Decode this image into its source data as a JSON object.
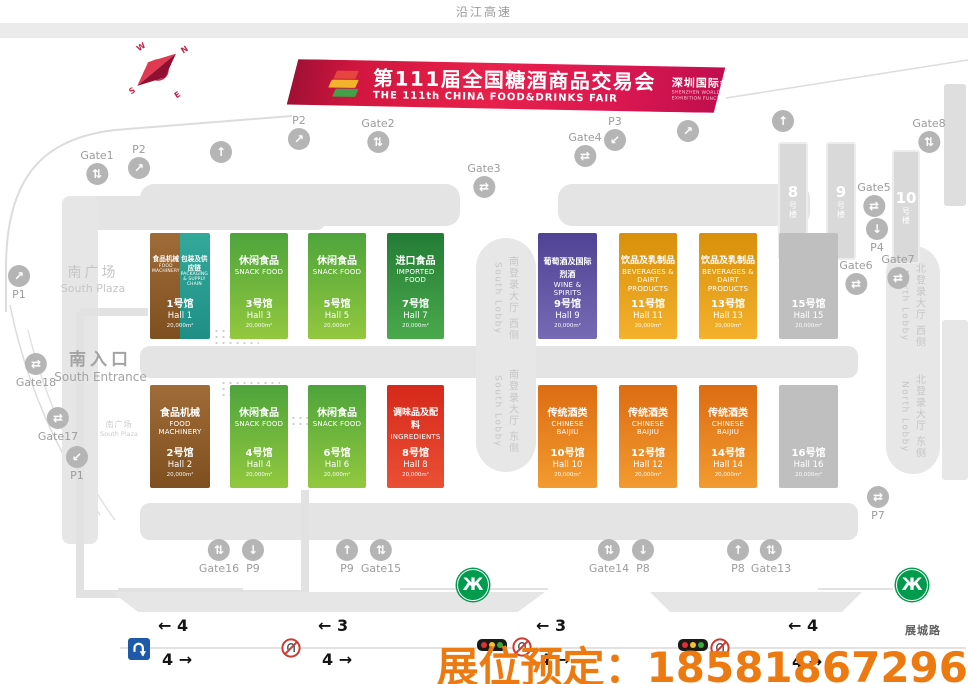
{
  "page": {
    "top_road": "沿江高速",
    "bottom_road": "展城路",
    "booking": "展位预定：18581867296"
  },
  "colors": {
    "banner_red": "#DD1C47",
    "booking_orange": "#EC7A10",
    "hall_brown": "#96622E",
    "hall_teal": "#2BA395",
    "hall_green": "#5FAE3C",
    "hall_dark_green": "#2E8F3C",
    "hall_purple": "#5D4F9E",
    "hall_amber": "#E9960E",
    "hall_orange": "#E9780F",
    "hall_red": "#DD2F1D",
    "hall_gray": "#BFBFBF",
    "metro_green": "#009B4C"
  },
  "banner": {
    "title_cn": "第111届全国糖酒商品交易会",
    "title_en": "THE 111th CHINA FOOD&DRINKS FAIR",
    "subtitle_cn": "深圳国际会展中心展区功能图",
    "subtitle_en1": "SHENZHEN WORLD EXHIBITION & CONVENTION CENTER",
    "subtitle_en2": "EXHIBITION FUNCTION DIAGRAM"
  },
  "compass": {
    "w": "W",
    "n": "N",
    "e": "E",
    "s": "S"
  },
  "areas": {
    "plaza_cn": "南广场",
    "plaza_en": "South Plaza",
    "entrance_cn": "南入口",
    "entrance_en": "South Entrance",
    "plaza_small_cn": "南广场",
    "plaza_small_en": "South Plaza"
  },
  "lobbies": {
    "south_west_cn": "南登录大厅 西侧",
    "south_west_en": "South Lobby",
    "south_east_cn": "南登录大厅 东侧",
    "south_east_en": "South Lobby",
    "north_west_cn": "北登录大厅 西侧",
    "north_west_en": "North Lobby",
    "north_east_cn": "北登录大厅 东侧",
    "north_east_en": "North Lobby"
  },
  "buildings": [
    {
      "no": "8",
      "suffix": "号楼"
    },
    {
      "no": "9",
      "suffix": "号楼"
    },
    {
      "no": "10",
      "suffix": "号楼"
    }
  ],
  "halls": [
    {
      "no": "1",
      "cat_cn": "食品机械",
      "cat_en": "FOOD MACHINERY",
      "cat2_cn": "包装及供应链",
      "cat2_en": "PACKAGING & SUPPLY CHAIN",
      "hall_cn": "1号馆",
      "hall_en": "Hall 1",
      "area": "20,000m²"
    },
    {
      "no": "2",
      "cat_cn": "食品机械",
      "cat_en": "FOOD MACHINERY",
      "hall_cn": "2号馆",
      "hall_en": "Hall 2",
      "area": "20,000m²"
    },
    {
      "no": "3",
      "cat_cn": "休闲食品",
      "cat_en": "SNACK FOOD",
      "hall_cn": "3号馆",
      "hall_en": "Hall 3",
      "area": "20,000m²"
    },
    {
      "no": "4",
      "cat_cn": "休闲食品",
      "cat_en": "SNACK FOOD",
      "hall_cn": "4号馆",
      "hall_en": "Hall 4",
      "area": "20,000m²"
    },
    {
      "no": "5",
      "cat_cn": "休闲食品",
      "cat_en": "SNACK FOOD",
      "hall_cn": "5号馆",
      "hall_en": "Hall 5",
      "area": "20,000m²"
    },
    {
      "no": "6",
      "cat_cn": "休闲食品",
      "cat_en": "SNACK FOOD",
      "hall_cn": "6号馆",
      "hall_en": "Hall 6",
      "area": "20,000m²"
    },
    {
      "no": "7",
      "cat_cn": "进口食品",
      "cat_en": "IMPORTED FOOD",
      "hall_cn": "7号馆",
      "hall_en": "Hall 7",
      "area": "20,000m²"
    },
    {
      "no": "8",
      "cat_cn": "调味品及配料",
      "cat_en": "INGREDIENTS",
      "hall_cn": "8号馆",
      "hall_en": "Hall 8",
      "area": "20,000m²"
    },
    {
      "no": "9",
      "cat_cn": "葡萄酒及国际烈酒",
      "cat_en": "WINE & SPIRITS",
      "hall_cn": "9号馆",
      "hall_en": "Hall 9",
      "area": "20,000m²"
    },
    {
      "no": "10",
      "cat_cn": "传统酒类",
      "cat_en": "CHINESE BAIJIU",
      "hall_cn": "10号馆",
      "hall_en": "Hall 10",
      "area": "20,000m²"
    },
    {
      "no": "11",
      "cat_cn": "饮品及乳制品",
      "cat_en": "BEVERAGES & DAIRT PRODUCTS",
      "hall_cn": "11号馆",
      "hall_en": "Hall 11",
      "area": "20,000m²"
    },
    {
      "no": "12",
      "cat_cn": "传统酒类",
      "cat_en": "CHINESE BAIJIU",
      "hall_cn": "12号馆",
      "hall_en": "Hall 12",
      "area": "20,000m²"
    },
    {
      "no": "13",
      "cat_cn": "饮品及乳制品",
      "cat_en": "BEVERAGES & DAIRT PRODUCTS",
      "hall_cn": "13号馆",
      "hall_en": "Hall 13",
      "area": "20,000m²"
    },
    {
      "no": "14",
      "cat_cn": "传统酒类",
      "cat_en": "CHINESE BAIJIU",
      "hall_cn": "14号馆",
      "hall_en": "Hall 14",
      "area": "20,000m²"
    },
    {
      "no": "15",
      "hall_cn": "15号馆",
      "hall_en": "Hall 15",
      "area": "20,000m²"
    },
    {
      "no": "16",
      "hall_cn": "16号馆",
      "hall_en": "Hall 16",
      "area": "20,000m²"
    }
  ],
  "markers": [
    {
      "label": "Gate1",
      "glyph": "⇅"
    },
    {
      "label": "P2",
      "glyph": "↗"
    },
    {
      "label": "P2",
      "glyph": "↗"
    },
    {
      "label": "Gate2",
      "glyph": "⇅"
    },
    {
      "label": "Gate3",
      "glyph": "⇄"
    },
    {
      "label": "",
      "glyph": "↑"
    },
    {
      "label": "Gate4",
      "glyph": "⇄"
    },
    {
      "label": "P3",
      "glyph": "↙"
    },
    {
      "label": "",
      "glyph": "↗"
    },
    {
      "label": "",
      "glyph": "↑"
    },
    {
      "label": "Gate8",
      "glyph": "⇅"
    },
    {
      "label": "Gate5",
      "glyph": "⇄"
    },
    {
      "label": "P4",
      "glyph": "↓"
    },
    {
      "label": "Gate6",
      "glyph": "⇄"
    },
    {
      "label": "Gate7",
      "glyph": "⇄"
    },
    {
      "label": "P1",
      "glyph": "↗"
    },
    {
      "label": "Gate18",
      "glyph": "⇄"
    },
    {
      "label": "Gate17",
      "glyph": "⇄"
    },
    {
      "label": "P1",
      "glyph": "↙"
    },
    {
      "label": "Gate16",
      "glyph": "⇅"
    },
    {
      "label": "P9",
      "glyph": "↓"
    },
    {
      "label": "P9",
      "glyph": "↑"
    },
    {
      "label": "Gate15",
      "glyph": "⇅"
    },
    {
      "label": "Gate14",
      "glyph": "⇅"
    },
    {
      "label": "P8",
      "glyph": "↓"
    },
    {
      "label": "P8",
      "glyph": "↑"
    },
    {
      "label": "Gate13",
      "glyph": "⇅"
    },
    {
      "label": "P7",
      "glyph": "⇄"
    }
  ],
  "traffic": {
    "groups": [
      {
        "up": "← 4",
        "down": "4 →"
      },
      {
        "up": "← 3",
        "down": "4 →"
      },
      {
        "up": "← 3",
        "down": "4 →"
      },
      {
        "up": "← 4",
        "down": "4 →"
      }
    ]
  },
  "icons": {
    "metro_glyph": "Ж"
  }
}
